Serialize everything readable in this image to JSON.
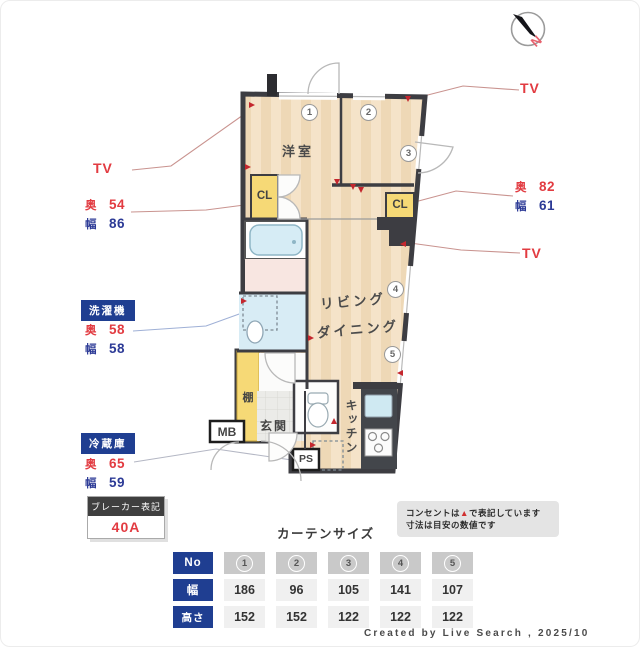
{
  "compass": {
    "north": "N"
  },
  "plan": {
    "rooms": {
      "bedroom": "洋室",
      "living": "リビング",
      "dining": "ダイニング",
      "kitchen": "キッチン",
      "entrance": "玄関",
      "shelf": "棚",
      "closet_left": "CL",
      "closet_right": "CL",
      "meter_box": "MB",
      "pipe_space": "PS"
    },
    "window_numbers": [
      "1",
      "2",
      "3",
      "4",
      "5"
    ]
  },
  "annotations": {
    "tv_left": {
      "label": "TV"
    },
    "tv_right_top": {
      "label": "TV"
    },
    "tv_right_mid": {
      "label": "TV"
    },
    "closet_left_dims": {
      "depth_label": "奥",
      "depth_value": "54",
      "width_label": "幅",
      "width_value": "86"
    },
    "closet_right_dims": {
      "depth_label": "奥",
      "depth_value": "82",
      "width_label": "幅",
      "width_value": "61"
    },
    "washer": {
      "title": "洗濯機",
      "depth_label": "奥",
      "depth_value": "58",
      "width_label": "幅",
      "width_value": "58"
    },
    "fridge": {
      "title": "冷蔵庫",
      "depth_label": "奥",
      "depth_value": "65",
      "width_label": "幅",
      "width_value": "59"
    },
    "breaker": {
      "title": "ブレーカー表記",
      "value": "40A"
    }
  },
  "note": {
    "line1_prefix": "コンセントは",
    "line1_marker": "▲",
    "line1_suffix": "で表記しています",
    "line2": "寸法は目安の数値です"
  },
  "curtain_table": {
    "title": "カーテンサイズ",
    "row_headers": [
      "No",
      "幅",
      "高さ"
    ],
    "columns": [
      "1",
      "2",
      "3",
      "4",
      "5"
    ],
    "rows": {
      "width": [
        "186",
        "96",
        "105",
        "141",
        "107"
      ],
      "height": [
        "152",
        "152",
        "122",
        "122",
        "122"
      ]
    }
  },
  "footer": {
    "credit": "Created by Live Search , 2025/10"
  },
  "colors": {
    "annotation_red": "#e23b41",
    "annotation_navy": "#2c3a96",
    "badge_navy": "#1f3e91",
    "wall": "#3d3d42",
    "floor": "#f5e3c9",
    "closet_yellow": "#f6d976",
    "water_blue": "#d8ecf5",
    "bath_pink": "#f8e6e1",
    "outlet_red": "#c4272e",
    "note_bg": "#e4e4e4"
  }
}
